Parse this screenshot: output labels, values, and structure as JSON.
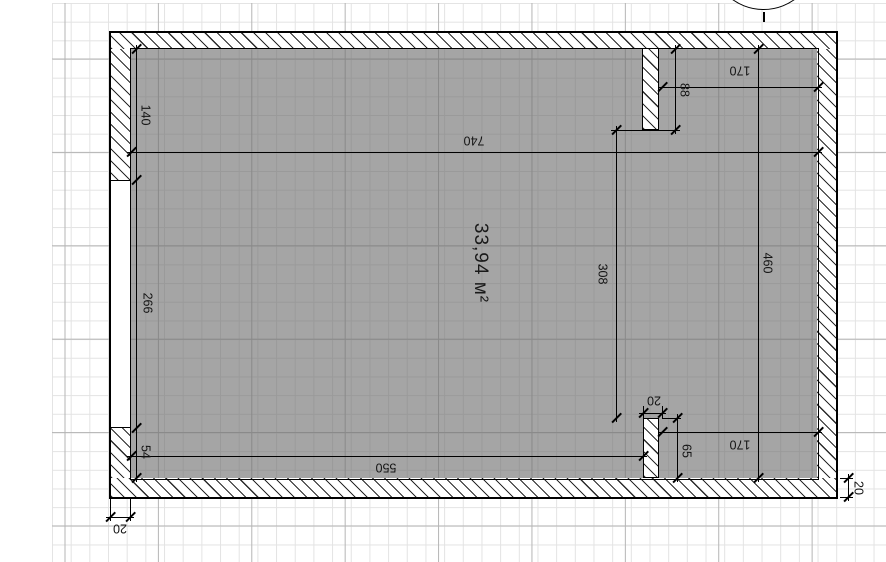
{
  "plan": {
    "area_label": "33,94 м²",
    "dims": {
      "left_upper": "140",
      "window_height": "266",
      "left_lower": "54",
      "inner_width": "740",
      "to_partition": "550",
      "top_niche_width": "170",
      "top_partition_length": "88",
      "free_span": "308",
      "inner_height": "460",
      "bottom_niche_width": "170",
      "bottom_partition_length": "65",
      "partition_thickness": "20",
      "wall_thickness_left": "20",
      "wall_thickness_bottom": "20"
    }
  },
  "colors": {
    "background": "#ffffff",
    "grid_minor": "#e3e3e3",
    "grid_major": "#b5b5b5",
    "room_fill": "#a5a5a5",
    "line": "#000000"
  }
}
